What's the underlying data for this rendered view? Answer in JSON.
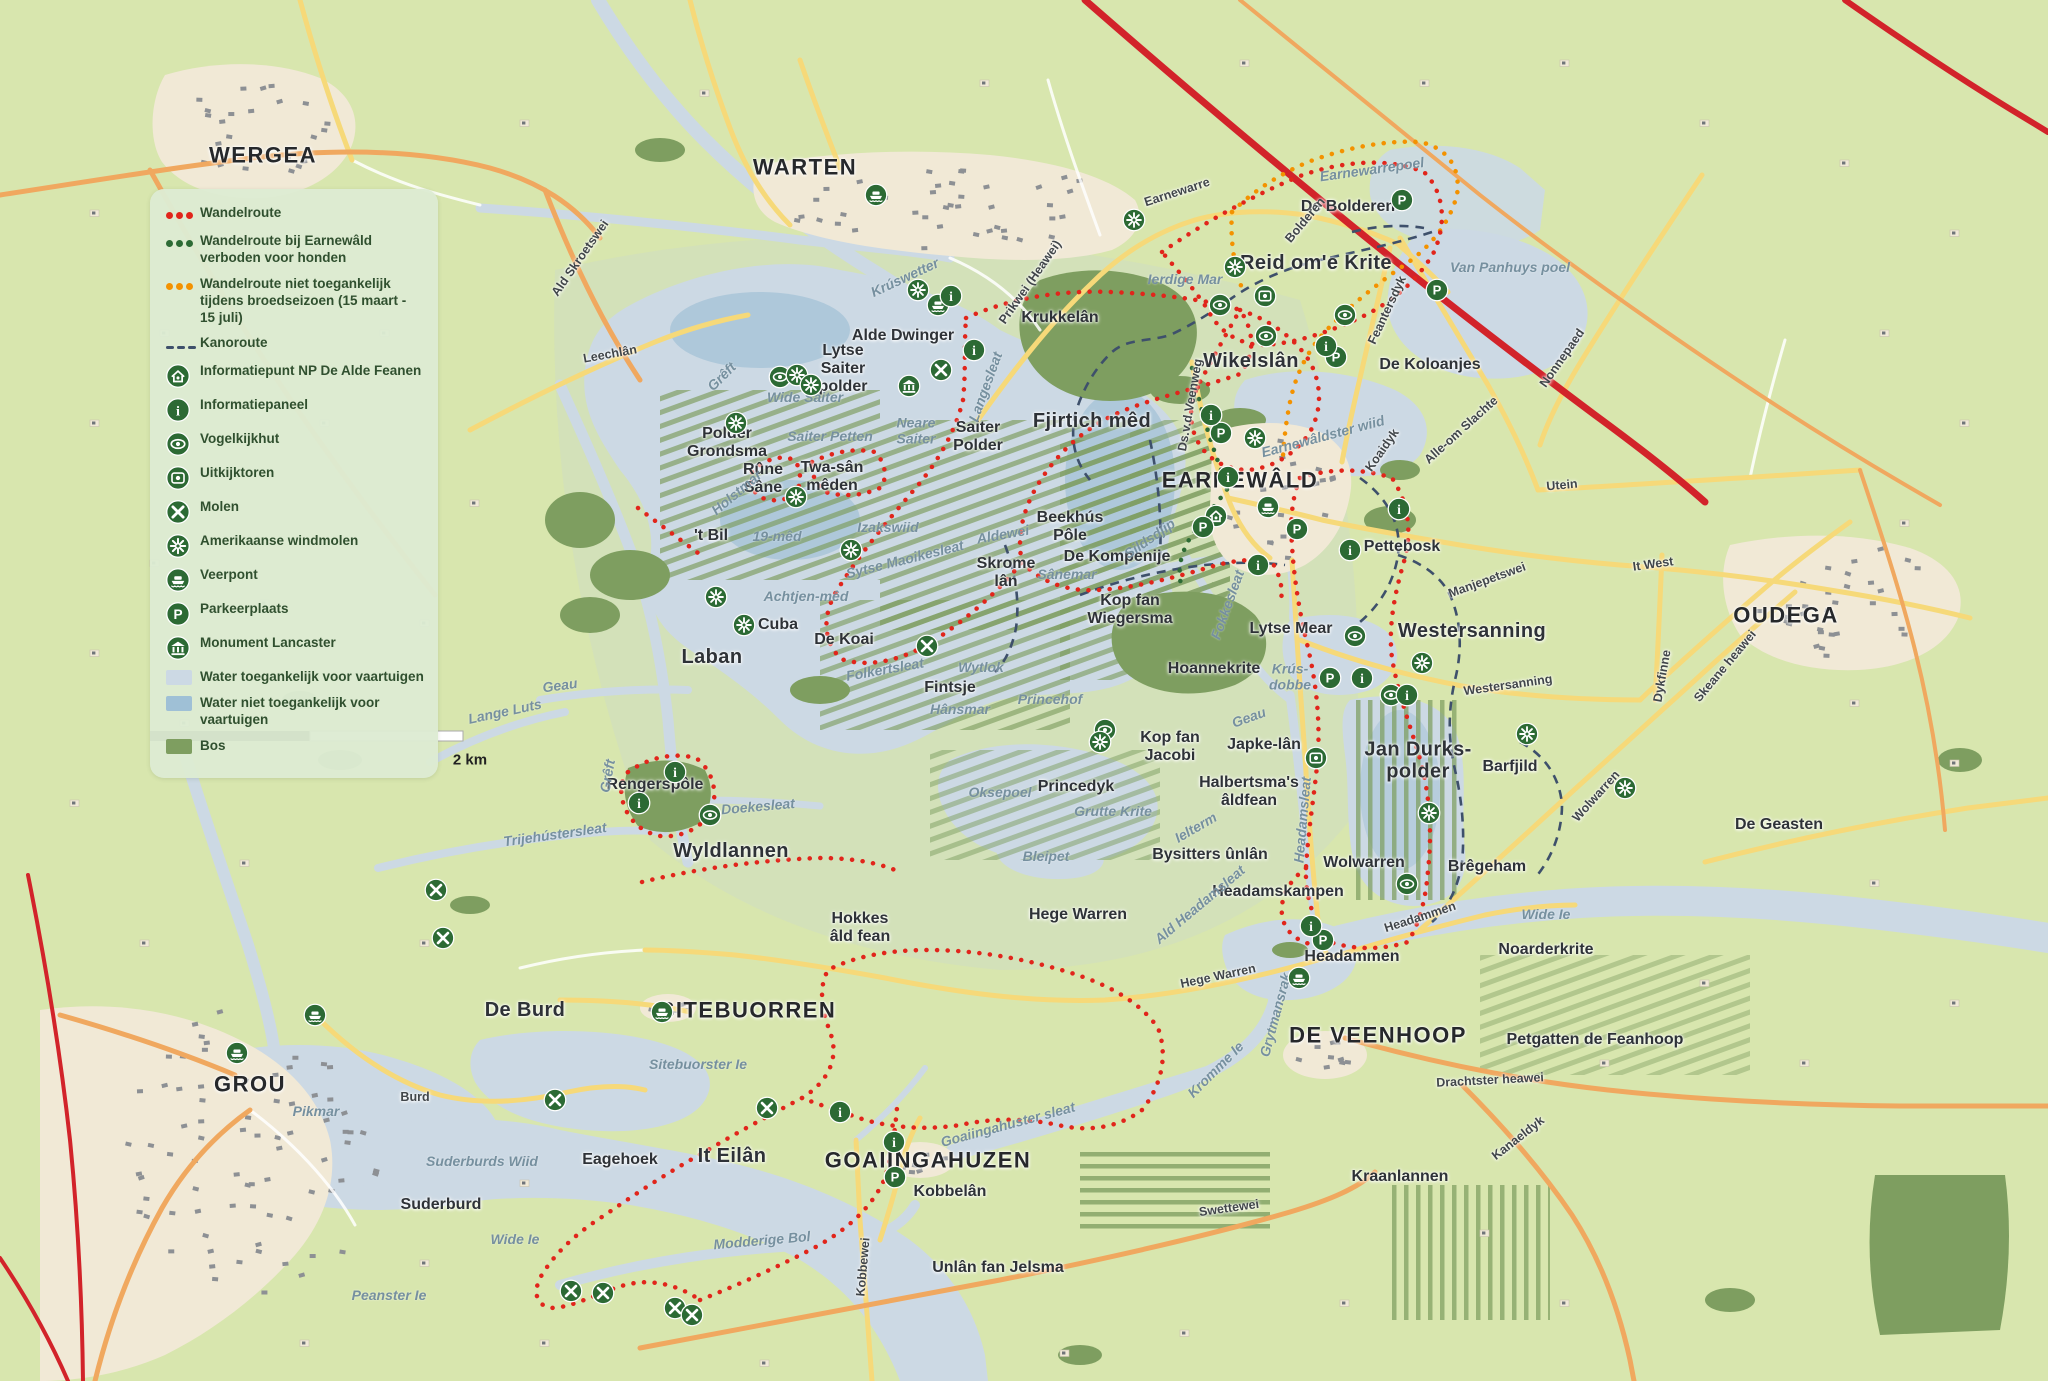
{
  "legend": {
    "items": [
      {
        "type": "dots",
        "color": "#e1251b",
        "label": "Wandelroute"
      },
      {
        "type": "dots",
        "color": "#2d6b35",
        "label": "Wandelroute bij Earnewâld verboden voor honden"
      },
      {
        "type": "dots",
        "color": "#f39200",
        "label": "Wandelroute niet toegankelijk tijdens broedseizoen (15 maart - 15 juli)"
      },
      {
        "type": "dash",
        "color": "#3e506b",
        "label": "Kanoroute"
      },
      {
        "type": "icon",
        "icon": "info-point",
        "label": "Informatiepunt NP De Alde Feanen"
      },
      {
        "type": "icon",
        "icon": "info-panel",
        "label": "Informatiepaneel"
      },
      {
        "type": "icon",
        "icon": "bird-hide",
        "label": "Vogelkijkhut"
      },
      {
        "type": "icon",
        "icon": "watchtower",
        "label": "Uitkijktoren"
      },
      {
        "type": "icon",
        "icon": "windmill",
        "label": "Molen"
      },
      {
        "type": "icon",
        "icon": "american-windmill",
        "label": "Amerikaanse windmolen"
      },
      {
        "type": "icon",
        "icon": "ferry",
        "label": "Veerpont"
      },
      {
        "type": "icon",
        "icon": "parking",
        "label": "Parkeerplaats"
      },
      {
        "type": "icon",
        "icon": "monument",
        "label": "Monument Lancaster"
      },
      {
        "type": "swatch",
        "color": "#ccd9e4",
        "label": "Water toegankelijk voor vaartuigen"
      },
      {
        "type": "swatch",
        "color": "#9fc0d6",
        "label": "Water niet toegankelijk voor vaartuigen"
      },
      {
        "type": "swatch",
        "color": "#7e9e60",
        "label": "Bos"
      }
    ]
  },
  "scale": {
    "label": "2 km"
  },
  "colors": {
    "icon_green": "#2c6a34",
    "route_red": "#e1251b",
    "route_orange": "#f39200",
    "route_green": "#2d6b35",
    "kanoroute": "#3e506b",
    "water_open": "#ccd9e4",
    "water_closed": "#9fc0d6",
    "forest": "#7e9e60",
    "road_yellow": "#f6d979",
    "road_orange": "#f0a85f",
    "highway_red": "#d2232a"
  },
  "labels": [
    {
      "t": "WERGEA",
      "x": 263,
      "y": 156,
      "c": "town"
    },
    {
      "t": "WARTEN",
      "x": 805,
      "y": 168,
      "c": "town"
    },
    {
      "t": "EARNEWÂLD",
      "x": 1240,
      "y": 481,
      "c": "town"
    },
    {
      "t": "OUDEGA",
      "x": 1786,
      "y": 616,
      "c": "town"
    },
    {
      "t": "GROU",
      "x": 250,
      "y": 1085,
      "c": "town"
    },
    {
      "t": "SITEBUORREN",
      "x": 748,
      "y": 1011,
      "c": "town"
    },
    {
      "t": "GOAIINGAHUZEN",
      "x": 928,
      "y": 1161,
      "c": "town"
    },
    {
      "t": "DE VEENHOOP",
      "x": 1378,
      "y": 1036,
      "c": "town"
    },
    {
      "t": "Alde Dwinger",
      "x": 903,
      "y": 336,
      "c": "area"
    },
    {
      "t": "Lytse\nSaiter\npolder",
      "x": 843,
      "y": 369,
      "c": "area"
    },
    {
      "t": "Polder\nGrondsma",
      "x": 727,
      "y": 443,
      "c": "area"
    },
    {
      "t": "Saiter\nPolder",
      "x": 978,
      "y": 437,
      "c": "area"
    },
    {
      "t": "Rûne\nSâne",
      "x": 763,
      "y": 479,
      "c": "area"
    },
    {
      "t": "Twa-sân\nmêden",
      "x": 832,
      "y": 477,
      "c": "area"
    },
    {
      "t": "'t Bil",
      "x": 711,
      "y": 536,
      "c": "area"
    },
    {
      "t": "Fjirtich mêd",
      "x": 1092,
      "y": 421,
      "c": "arealg"
    },
    {
      "t": "Wikelslân",
      "x": 1251,
      "y": 361,
      "c": "arealg"
    },
    {
      "t": "Reid om'e Krite",
      "x": 1316,
      "y": 263,
      "c": "arealg"
    },
    {
      "t": "De Bolderen",
      "x": 1348,
      "y": 207,
      "c": "area"
    },
    {
      "t": "Krukkelân",
      "x": 1060,
      "y": 318,
      "c": "area"
    },
    {
      "t": "De Koloanjes",
      "x": 1430,
      "y": 365,
      "c": "area"
    },
    {
      "t": "Beekhús\nPôle",
      "x": 1070,
      "y": 527,
      "c": "area"
    },
    {
      "t": "De Kompenije",
      "x": 1117,
      "y": 557,
      "c": "area"
    },
    {
      "t": "Kop fan\nWiegersma",
      "x": 1130,
      "y": 610,
      "c": "area"
    },
    {
      "t": "Hoannekrite",
      "x": 1214,
      "y": 669,
      "c": "area"
    },
    {
      "t": "Skrome\nlân",
      "x": 1006,
      "y": 573,
      "c": "area"
    },
    {
      "t": "Kop fan\nJacobi",
      "x": 1170,
      "y": 747,
      "c": "area"
    },
    {
      "t": "Japke-lân",
      "x": 1264,
      "y": 745,
      "c": "area"
    },
    {
      "t": "Princedyk",
      "x": 1076,
      "y": 787,
      "c": "area"
    },
    {
      "t": "Halbertsma's\nâldfean",
      "x": 1249,
      "y": 792,
      "c": "area"
    },
    {
      "t": "Bysitters ûnlân",
      "x": 1210,
      "y": 855,
      "c": "area"
    },
    {
      "t": "Headamskampen",
      "x": 1278,
      "y": 892,
      "c": "area"
    },
    {
      "t": "Wolwarren",
      "x": 1364,
      "y": 863,
      "c": "area"
    },
    {
      "t": "Jan Durks-\npolder",
      "x": 1418,
      "y": 761,
      "c": "arealg"
    },
    {
      "t": "Barfjild",
      "x": 1510,
      "y": 767,
      "c": "area"
    },
    {
      "t": "Brêgeham",
      "x": 1487,
      "y": 867,
      "c": "area"
    },
    {
      "t": "Westersanning",
      "x": 1472,
      "y": 631,
      "c": "arealg"
    },
    {
      "t": "Pettebosk",
      "x": 1402,
      "y": 547,
      "c": "area"
    },
    {
      "t": "Laban",
      "x": 712,
      "y": 657,
      "c": "arealg"
    },
    {
      "t": "Cuba",
      "x": 778,
      "y": 625,
      "c": "area"
    },
    {
      "t": "De Koai",
      "x": 844,
      "y": 640,
      "c": "area"
    },
    {
      "t": "Fintsje",
      "x": 950,
      "y": 688,
      "c": "area"
    },
    {
      "t": "Wyldlannen",
      "x": 731,
      "y": 851,
      "c": "arealg"
    },
    {
      "t": "De Burd",
      "x": 525,
      "y": 1010,
      "c": "arealg"
    },
    {
      "t": "Suderburd",
      "x": 441,
      "y": 1205,
      "c": "area"
    },
    {
      "t": "Eagehoek",
      "x": 620,
      "y": 1160,
      "c": "area"
    },
    {
      "t": "It Eilân",
      "x": 732,
      "y": 1156,
      "c": "arealg"
    },
    {
      "t": "Kobbelân",
      "x": 950,
      "y": 1192,
      "c": "area"
    },
    {
      "t": "Unlân fan Jelsma",
      "x": 998,
      "y": 1268,
      "c": "area"
    },
    {
      "t": "Hokkes\nâld fean",
      "x": 860,
      "y": 928,
      "c": "area"
    },
    {
      "t": "Hege Warren",
      "x": 1078,
      "y": 915,
      "c": "area"
    },
    {
      "t": "Headammen",
      "x": 1352,
      "y": 957,
      "c": "area"
    },
    {
      "t": "Noarderkrite",
      "x": 1546,
      "y": 950,
      "c": "area"
    },
    {
      "t": "Petgatten de Feanhoop",
      "x": 1595,
      "y": 1040,
      "c": "area"
    },
    {
      "t": "Kraanlannen",
      "x": 1400,
      "y": 1177,
      "c": "area"
    },
    {
      "t": "De Geasten",
      "x": 1779,
      "y": 825,
      "c": "area"
    },
    {
      "t": "Lytse Mear",
      "x": 1291,
      "y": 629,
      "c": "area"
    },
    {
      "t": "Rengerspôle",
      "x": 655,
      "y": 785,
      "c": "area"
    },
    {
      "t": "Earnewarrepoel",
      "x": 1372,
      "y": 170,
      "c": "water",
      "r": -8
    },
    {
      "t": "Van Panhuys poel",
      "x": 1510,
      "y": 268,
      "c": "water"
    },
    {
      "t": "Ierdige Mar",
      "x": 1185,
      "y": 280,
      "c": "water"
    },
    {
      "t": "Wide Saiter",
      "x": 805,
      "y": 398,
      "c": "water"
    },
    {
      "t": "Saiter Petten",
      "x": 830,
      "y": 437,
      "c": "water"
    },
    {
      "t": "Neare\nSaiter",
      "x": 916,
      "y": 431,
      "c": "water"
    },
    {
      "t": "Izakswiid",
      "x": 888,
      "y": 528,
      "c": "water"
    },
    {
      "t": "Holstmar",
      "x": 737,
      "y": 493,
      "c": "water",
      "r": -40
    },
    {
      "t": "19-mêd",
      "x": 777,
      "y": 537,
      "c": "water"
    },
    {
      "t": "Achtjen-mêd",
      "x": 806,
      "y": 597,
      "c": "water"
    },
    {
      "t": "Sânemar",
      "x": 1067,
      "y": 575,
      "c": "water"
    },
    {
      "t": "Sildsdjip",
      "x": 1150,
      "y": 539,
      "c": "water",
      "r": -35
    },
    {
      "t": "Aldewei",
      "x": 1003,
      "y": 535,
      "c": "water",
      "r": -10
    },
    {
      "t": "Sytse Maoikesleat",
      "x": 905,
      "y": 560,
      "c": "water",
      "r": -14
    },
    {
      "t": "Folkertsleat",
      "x": 885,
      "y": 670,
      "c": "water",
      "r": -10
    },
    {
      "t": "Hânsmar",
      "x": 960,
      "y": 710,
      "c": "water"
    },
    {
      "t": "Wytlok",
      "x": 981,
      "y": 668,
      "c": "water"
    },
    {
      "t": "Princehof",
      "x": 1050,
      "y": 700,
      "c": "water"
    },
    {
      "t": "Oksepoel",
      "x": 1000,
      "y": 793,
      "c": "water"
    },
    {
      "t": "Grutte Krite",
      "x": 1113,
      "y": 812,
      "c": "water"
    },
    {
      "t": "Bleipet",
      "x": 1046,
      "y": 857,
      "c": "water"
    },
    {
      "t": "Ielterm",
      "x": 1196,
      "y": 828,
      "c": "water",
      "r": -30
    },
    {
      "t": "Geau",
      "x": 1249,
      "y": 718,
      "c": "water",
      "r": -20
    },
    {
      "t": "Geau",
      "x": 560,
      "y": 686,
      "c": "water",
      "r": -8
    },
    {
      "t": "Krús-\ndobbe",
      "x": 1290,
      "y": 677,
      "c": "water"
    },
    {
      "t": "Earnewâldster wiid",
      "x": 1323,
      "y": 437,
      "c": "water",
      "r": -15
    },
    {
      "t": "Fokkesleat",
      "x": 1228,
      "y": 605,
      "c": "water",
      "r": -70
    },
    {
      "t": "Headamsleat",
      "x": 1303,
      "y": 820,
      "c": "water",
      "r": -85
    },
    {
      "t": "Ald Headamsleat",
      "x": 1200,
      "y": 905,
      "c": "water",
      "r": -40
    },
    {
      "t": "Grytmansrak",
      "x": 1276,
      "y": 1015,
      "c": "water",
      "r": -75
    },
    {
      "t": "Kromme Ie",
      "x": 1216,
      "y": 1070,
      "c": "water",
      "r": -45
    },
    {
      "t": "Goaiingahuster sleat",
      "x": 1008,
      "y": 1125,
      "c": "water",
      "r": -15
    },
    {
      "t": "Sitebuorster Ie",
      "x": 698,
      "y": 1065,
      "c": "water"
    },
    {
      "t": "Modderige Bol",
      "x": 762,
      "y": 1241,
      "c": "water",
      "r": -5
    },
    {
      "t": "Pikmar",
      "x": 316,
      "y": 1112,
      "c": "water"
    },
    {
      "t": "Suderburds Wiid",
      "x": 482,
      "y": 1162,
      "c": "water"
    },
    {
      "t": "Wide Ie",
      "x": 515,
      "y": 1240,
      "c": "water"
    },
    {
      "t": "Peanster Ie",
      "x": 389,
      "y": 1296,
      "c": "water"
    },
    {
      "t": "Wide Ie",
      "x": 1546,
      "y": 915,
      "c": "water"
    },
    {
      "t": "Langesleat",
      "x": 986,
      "y": 387,
      "c": "water",
      "r": -70
    },
    {
      "t": "Lange Luts",
      "x": 505,
      "y": 712,
      "c": "water",
      "r": -12
    },
    {
      "t": "Doekesleat",
      "x": 758,
      "y": 807,
      "c": "water",
      "r": -5
    },
    {
      "t": "Trijehústersleat",
      "x": 555,
      "y": 835,
      "c": "water",
      "r": -8
    },
    {
      "t": "Grêft",
      "x": 722,
      "y": 377,
      "c": "water",
      "r": -45
    },
    {
      "t": "Grêft",
      "x": 608,
      "y": 776,
      "c": "water",
      "r": -80
    },
    {
      "t": "Krúswetter",
      "x": 905,
      "y": 278,
      "c": "water",
      "r": -25
    },
    {
      "t": "Ald Skroetswei",
      "x": 580,
      "y": 258,
      "c": "road",
      "r": -55
    },
    {
      "t": "Leechlân",
      "x": 610,
      "y": 354,
      "c": "road",
      "r": -10
    },
    {
      "t": "Prikwei (Heawei)",
      "x": 1030,
      "y": 282,
      "c": "road",
      "r": -55
    },
    {
      "t": "Earnewarre",
      "x": 1177,
      "y": 192,
      "c": "road",
      "r": -18
    },
    {
      "t": "Bolderen",
      "x": 1305,
      "y": 220,
      "c": "road",
      "r": -50
    },
    {
      "t": "Feantersdyk",
      "x": 1387,
      "y": 310,
      "c": "road",
      "r": -65
    },
    {
      "t": "Nonnepaed",
      "x": 1562,
      "y": 358,
      "c": "road",
      "r": -55
    },
    {
      "t": "Alle-om Slachte",
      "x": 1461,
      "y": 430,
      "c": "road",
      "r": -42
    },
    {
      "t": "Utein",
      "x": 1562,
      "y": 485,
      "c": "road",
      "r": -5
    },
    {
      "t": "Manjepetswei",
      "x": 1487,
      "y": 580,
      "c": "road",
      "r": -20
    },
    {
      "t": "It West",
      "x": 1653,
      "y": 564,
      "c": "road",
      "r": -8
    },
    {
      "t": "Westersanning",
      "x": 1508,
      "y": 685,
      "c": "road",
      "r": -8
    },
    {
      "t": "Dykfinne",
      "x": 1662,
      "y": 676,
      "c": "road",
      "r": -80
    },
    {
      "t": "Skeane heawei",
      "x": 1725,
      "y": 666,
      "c": "road",
      "r": -50
    },
    {
      "t": "Koaidyk",
      "x": 1382,
      "y": 450,
      "c": "road",
      "r": -55
    },
    {
      "t": "Ds.v.d.Veenweg",
      "x": 1190,
      "y": 405,
      "c": "road",
      "r": -80
    },
    {
      "t": "Wolwarren",
      "x": 1596,
      "y": 796,
      "c": "road",
      "r": -48
    },
    {
      "t": "Headammen",
      "x": 1420,
      "y": 917,
      "c": "road",
      "r": -18
    },
    {
      "t": "Hege Warren",
      "x": 1218,
      "y": 976,
      "c": "road",
      "r": -12
    },
    {
      "t": "Burd",
      "x": 415,
      "y": 1097,
      "c": "road"
    },
    {
      "t": "Kobbewei",
      "x": 863,
      "y": 1267,
      "c": "road",
      "r": -85
    },
    {
      "t": "Swettewei",
      "x": 1229,
      "y": 1208,
      "c": "road",
      "r": -8
    },
    {
      "t": "Drachtster heawei",
      "x": 1490,
      "y": 1080,
      "c": "road",
      "r": -3
    },
    {
      "t": "Kanaeldyk",
      "x": 1518,
      "y": 1138,
      "c": "road",
      "r": -38
    }
  ],
  "markers": [
    {
      "type": "ferry",
      "x": 876,
      "y": 195
    },
    {
      "type": "ferry",
      "x": 938,
      "y": 305
    },
    {
      "type": "ferry",
      "x": 1268,
      "y": 507
    },
    {
      "type": "ferry",
      "x": 662,
      "y": 1012
    },
    {
      "type": "ferry",
      "x": 1299,
      "y": 978
    },
    {
      "type": "ferry",
      "x": 315,
      "y": 1015
    },
    {
      "type": "ferry",
      "x": 237,
      "y": 1053
    },
    {
      "type": "info-point",
      "x": 1216,
      "y": 516
    },
    {
      "type": "monument",
      "x": 909,
      "y": 386
    },
    {
      "type": "watchtower",
      "x": 1265,
      "y": 296
    },
    {
      "type": "watchtower",
      "x": 1316,
      "y": 758
    },
    {
      "type": "bird-hide",
      "x": 780,
      "y": 377
    },
    {
      "type": "bird-hide",
      "x": 1220,
      "y": 305
    },
    {
      "type": "bird-hide",
      "x": 1345,
      "y": 315
    },
    {
      "type": "bird-hide",
      "x": 1266,
      "y": 336
    },
    {
      "type": "bird-hide",
      "x": 1105,
      "y": 730
    },
    {
      "type": "bird-hide",
      "x": 1355,
      "y": 636
    },
    {
      "type": "bird-hide",
      "x": 1391,
      "y": 695
    },
    {
      "type": "bird-hide",
      "x": 1407,
      "y": 884
    },
    {
      "type": "bird-hide",
      "x": 710,
      "y": 815
    },
    {
      "type": "windmill",
      "x": 941,
      "y": 370
    },
    {
      "type": "windmill",
      "x": 927,
      "y": 646
    },
    {
      "type": "windmill",
      "x": 436,
      "y": 890
    },
    {
      "type": "windmill",
      "x": 443,
      "y": 938
    },
    {
      "type": "windmill",
      "x": 555,
      "y": 1100
    },
    {
      "type": "windmill",
      "x": 571,
      "y": 1291
    },
    {
      "type": "windmill",
      "x": 603,
      "y": 1293
    },
    {
      "type": "windmill",
      "x": 675,
      "y": 1308
    },
    {
      "type": "windmill",
      "x": 692,
      "y": 1315
    },
    {
      "type": "windmill",
      "x": 767,
      "y": 1108
    },
    {
      "type": "american-windmill",
      "x": 918,
      "y": 290
    },
    {
      "type": "american-windmill",
      "x": 797,
      "y": 375
    },
    {
      "type": "american-windmill",
      "x": 811,
      "y": 385
    },
    {
      "type": "american-windmill",
      "x": 736,
      "y": 423
    },
    {
      "type": "american-windmill",
      "x": 796,
      "y": 497
    },
    {
      "type": "american-windmill",
      "x": 851,
      "y": 550
    },
    {
      "type": "american-windmill",
      "x": 716,
      "y": 597
    },
    {
      "type": "american-windmill",
      "x": 744,
      "y": 625
    },
    {
      "type": "american-windmill",
      "x": 1255,
      "y": 438
    },
    {
      "type": "american-windmill",
      "x": 1100,
      "y": 742
    },
    {
      "type": "american-windmill",
      "x": 1134,
      "y": 220
    },
    {
      "type": "american-windmill",
      "x": 1235,
      "y": 267
    },
    {
      "type": "american-windmill",
      "x": 1527,
      "y": 734
    },
    {
      "type": "american-windmill",
      "x": 1429,
      "y": 813
    },
    {
      "type": "american-windmill",
      "x": 1625,
      "y": 788
    },
    {
      "type": "american-windmill",
      "x": 1422,
      "y": 663
    },
    {
      "type": "parking",
      "x": 1221,
      "y": 433
    },
    {
      "type": "parking",
      "x": 1203,
      "y": 527
    },
    {
      "type": "parking",
      "x": 1297,
      "y": 529
    },
    {
      "type": "parking",
      "x": 1402,
      "y": 200
    },
    {
      "type": "parking",
      "x": 1437,
      "y": 290
    },
    {
      "type": "parking",
      "x": 1330,
      "y": 678
    },
    {
      "type": "parking",
      "x": 1336,
      "y": 357
    },
    {
      "type": "parking",
      "x": 895,
      "y": 1177
    },
    {
      "type": "parking",
      "x": 1323,
      "y": 940
    },
    {
      "type": "info-panel",
      "x": 951,
      "y": 296
    },
    {
      "type": "info-panel",
      "x": 974,
      "y": 350
    },
    {
      "type": "info-panel",
      "x": 1326,
      "y": 346
    },
    {
      "type": "info-panel",
      "x": 1228,
      "y": 477
    },
    {
      "type": "info-panel",
      "x": 1211,
      "y": 415
    },
    {
      "type": "info-panel",
      "x": 1258,
      "y": 565
    },
    {
      "type": "info-panel",
      "x": 1399,
      "y": 509
    },
    {
      "type": "info-panel",
      "x": 1350,
      "y": 550
    },
    {
      "type": "info-panel",
      "x": 894,
      "y": 1142
    },
    {
      "type": "info-panel",
      "x": 840,
      "y": 1112
    },
    {
      "type": "info-panel",
      "x": 675,
      "y": 772
    },
    {
      "type": "info-panel",
      "x": 639,
      "y": 803
    },
    {
      "type": "info-panel",
      "x": 1311,
      "y": 926
    },
    {
      "type": "info-panel",
      "x": 1362,
      "y": 678
    },
    {
      "type": "info-panel",
      "x": 1407,
      "y": 695
    }
  ]
}
